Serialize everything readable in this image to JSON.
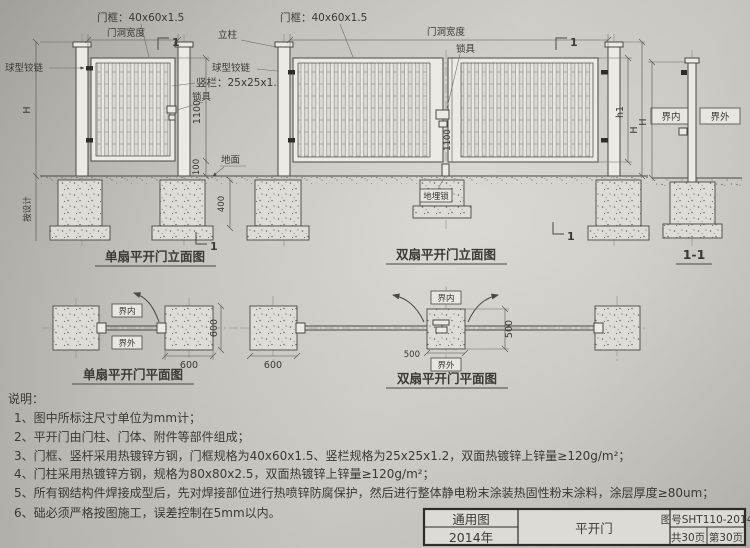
{
  "sheet": {
    "views": {
      "single_elev": {
        "caption": "单扇平开门立面图",
        "frame_spec": "门框：40x60x1.5",
        "opening_width": "门洞宽度",
        "hinge": "球型铰链",
        "bar_spec": "竖栏：25x25x1.2",
        "lock": "锁具",
        "dim_h": "H",
        "dim_leaf": "1100",
        "dim_gap": "100",
        "dim_embed": "400",
        "ground": "地面",
        "depth_note": "按设计",
        "section_no": "1"
      },
      "double_elev": {
        "caption": "双扇平开门立面图",
        "frame_spec": "门框：40x60x1.5",
        "opening_width": "门洞宽度",
        "post": "立柱",
        "hinge": "球型铰链",
        "lock": "锁具",
        "ground_lock": "地埋锁",
        "dim_leaf": "1100",
        "dim_h1": "h1",
        "dim_h": "H",
        "section_no": "1"
      },
      "section_1_1": {
        "caption": "1-1",
        "inside": "界内",
        "outside": "界外",
        "dim_h": "H"
      },
      "single_plan": {
        "caption": "单扇平开门平面图",
        "inside": "界内",
        "outside": "界外",
        "dim_w": "600",
        "dim_d": "600"
      },
      "double_plan": {
        "caption": "双扇平开门平面图",
        "inside": "界内",
        "outside": "界外",
        "dim_w": "500",
        "dim_d": "500",
        "dim_post": "600"
      }
    },
    "notes": {
      "heading": "说明：",
      "items": [
        "1、图中所标注尺寸单位为mm计；",
        "2、平开门由门柱、门体、附件等部件组成；",
        "3、门框、竖杆采用热镀锌方钢，门框规格为40x60x1.5、竖栏规格为25x25x1.2，双面热镀锌上锌量≥120g/m²；",
        "4、门柱采用热镀锌方钢，规格为80x80x2.5，双面热镀锌上锌量≥120g/m²；",
        "5、所有钢结构件焊接成型后，先对焊接部位进行热喷锌防腐保护，然后进行整体静电粉末涂装热固性粉末涂料，涂层厚度≥80um；",
        "6、础必须严格按图施工，误差控制在5mm以内。"
      ]
    },
    "title_block": {
      "type_label": "通用图",
      "year": "2014年",
      "drawing_name": "平开门",
      "drawing_no": "图号SHT110-2014",
      "total_pages": "共30页",
      "page": "第30页"
    }
  }
}
